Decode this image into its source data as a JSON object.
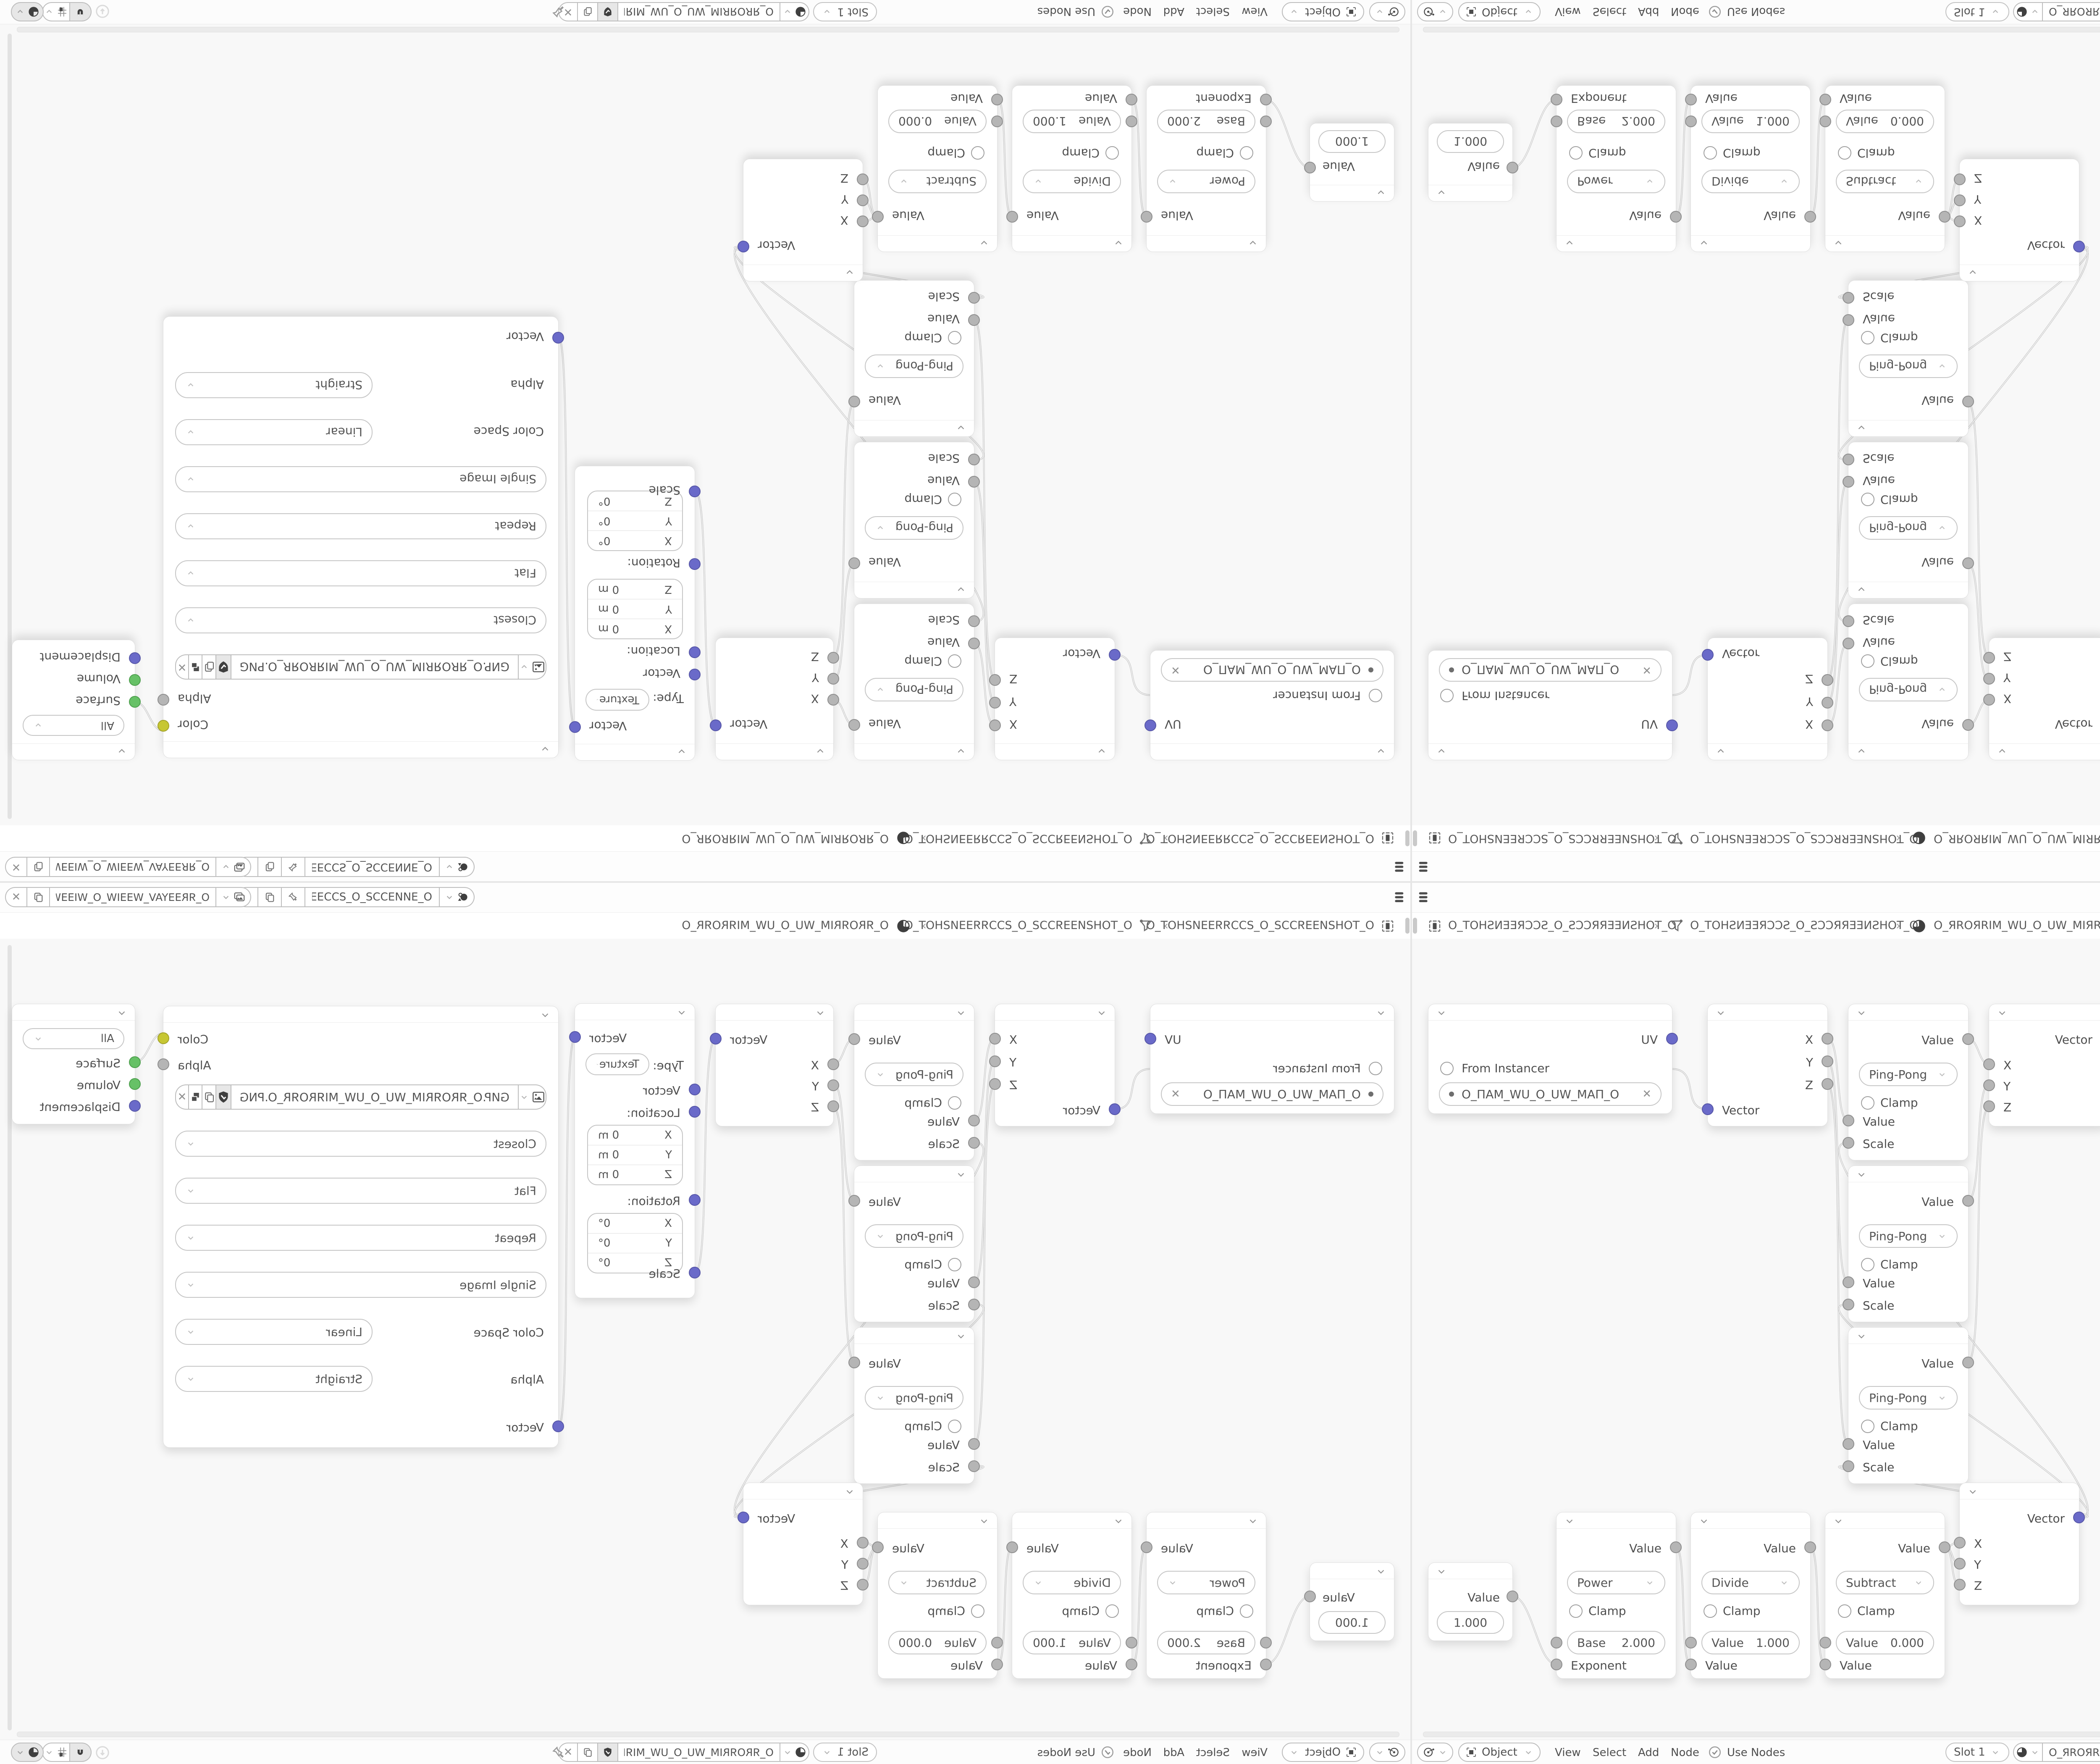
{
  "window": {
    "layout": "four mirrored quadrants of one Blender shader editor screenshot",
    "accent_colors": {
      "socket_vector": "#6a6ac9",
      "socket_shader": "#67c167",
      "socket_color": "#c7c733",
      "socket_value": "#b5b5b5"
    }
  },
  "topbar": {
    "scene_selector": {
      "value": "O_ƎИИƎƆƆƧ_O_ƧƆƆƎƎИ…"
    },
    "view_layer_selector": {
      "value": "O_ЯRƎƎYAV_WƎƎIW_O_WIƎƎW_VAYƎƎRR_O"
    },
    "close_label": "✕"
  },
  "breadcrumb": {
    "scene": "O_TOHƧИƎƎЯƆƆƧ_O_ƧƆƆЯЯƎƎИƧHOT_O",
    "view_layer": "O_TOHƧИƎƎЯƆƆƧ_O_ƧƆƆЯЯƎƎИƧHOT_O",
    "material": "O_ЯROЯRIM_WU_O_UW_MIЯROЯR_O",
    "separator": "›"
  },
  "editor_header": {
    "shading_mode": "Object",
    "menus": {
      "view": "View",
      "select": "Select",
      "add": "Add",
      "node": "Node"
    },
    "use_nodes": "Use Nodes",
    "slot": "Slot 1",
    "material_name": "O_ЯROЯRIM_WU_O_UW_MIЯROЯR_O",
    "close_label": "✕"
  },
  "nodes": {
    "uv_map": {
      "output": "UV",
      "from_instancer": "From Instancer",
      "uv_name": "O_ПAM_WU_O_UW_MAП_O",
      "close_label": "✕"
    },
    "separate_xyz": {
      "x": "X",
      "y": "Y",
      "z": "Z",
      "vector": "Vector"
    },
    "math_pingpong": {
      "output": "Value",
      "operation": "Ping-Pong",
      "clamp": "Clamp",
      "value_in": "Value",
      "scale_in": "Scale"
    },
    "combine_xyz": {
      "output": "Vector",
      "x": "X",
      "y": "Y",
      "z": "Z"
    },
    "mapping": {
      "output": "Vector",
      "type_label": "Type:",
      "type_value": "Texture",
      "vector_in": "Vector",
      "location_label": "Location:",
      "rotation_label": "Rotation:",
      "scale_label": "Scale",
      "axis_x": "X",
      "axis_y": "Y",
      "axis_z": "Z",
      "loc_value": "0 m",
      "rot_value": "0°"
    },
    "image_texture": {
      "color_out": "Color",
      "alpha_out": "Alpha",
      "filename": "GИP.O_ЯROЯRIM_WU_O_UW_MIЯROЯR_O.PNG",
      "interpolation": "Closest",
      "projection": "Flat",
      "extension": "Repeat",
      "source": "Single Image",
      "color_space_label": "Color Space",
      "color_space": "Linear",
      "alpha_label": "Alpha",
      "alpha_mode": "Straight",
      "vector_in": "Vector",
      "close_label": "✕"
    },
    "material_output": {
      "target": "All",
      "surface": "Surface",
      "volume": "Volume",
      "displacement": "Displacement"
    },
    "value_node": {
      "output": "Value",
      "value": "1.000"
    },
    "math_power": {
      "output": "Value",
      "operation": "Power",
      "clamp": "Clamp",
      "field_label": "Base",
      "field_value": "2.000",
      "input": "Exponent"
    },
    "math_divide": {
      "output": "Value",
      "operation": "Divide",
      "clamp": "Clamp",
      "field_label": "Value",
      "field_value": "1.000",
      "input": "Value"
    },
    "math_subtract": {
      "output": "Value",
      "operation": "Subtract",
      "clamp": "Clamp",
      "field_label": "Value",
      "field_value": "0.000",
      "input": "Value"
    }
  }
}
